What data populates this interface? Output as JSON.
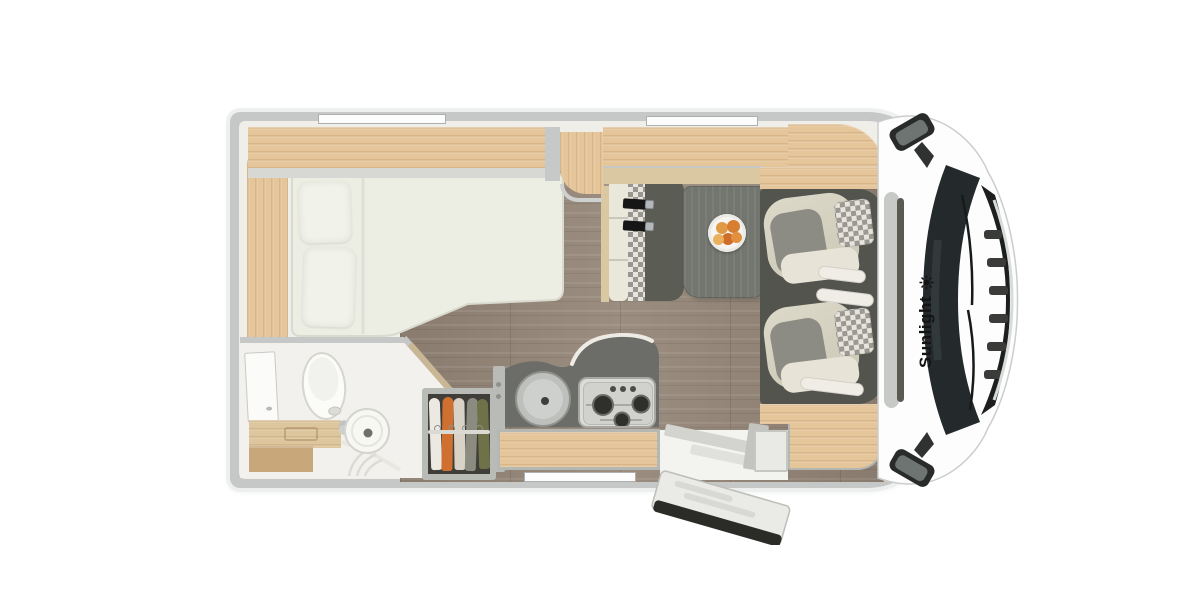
{
  "branding": {
    "name": "Sunlight",
    "logo": "sun-swirl-icon"
  },
  "colors": {
    "wall": "#c6c8c7",
    "interior": "#efeee9",
    "wood": "#e5c59a",
    "wood-dark": "#c8a77b",
    "tan": "#d9c8a2",
    "floor": "#8e8174",
    "counter": "#6c6d68",
    "cab-floor": "#53544d",
    "table": "#73766f",
    "bench": "#5b5c54",
    "seat-gray": "#8d8c84",
    "cushion": "#e7e3d6",
    "checker-light": "#e6e4dc",
    "checker-dark": "#98968e",
    "mattress": "#ecede3",
    "glass": "#242a2b",
    "grille": "#1d1e1e",
    "chrome": "#d7dcdb",
    "belt": "#161616",
    "brand-text": "#141414",
    "cloth-1": "#ece9e2",
    "cloth-2": "#cf7030",
    "cloth-3": "#d9d3c7",
    "cloth-4": "#8b8b80",
    "cloth-5": "#6f7148",
    "fruit-1": "#e09a45",
    "fruit-2": "#d77e31",
    "fruit-3": "#cf6e2b",
    "fruit-4": "#eab05e",
    "fruit-5": "#e28f3e"
  },
  "features": {
    "bed": "double-bed-with-two-pillows",
    "rear_shelves": "rear-wardrobe-shelves",
    "bathroom": "toilet-washbasin-shower",
    "wardrobe": "wardrobe-with-hanging-clothes",
    "kitchen": "round-sink-and-gas-stove",
    "burner_count": 3,
    "dinette": "table-with-fruit-plate-and-belted-bench-seat",
    "cab": "two-swivel-captain-seats",
    "entrance": "open-entry-door-with-step",
    "window_slots": 3,
    "mirrors": 2
  }
}
